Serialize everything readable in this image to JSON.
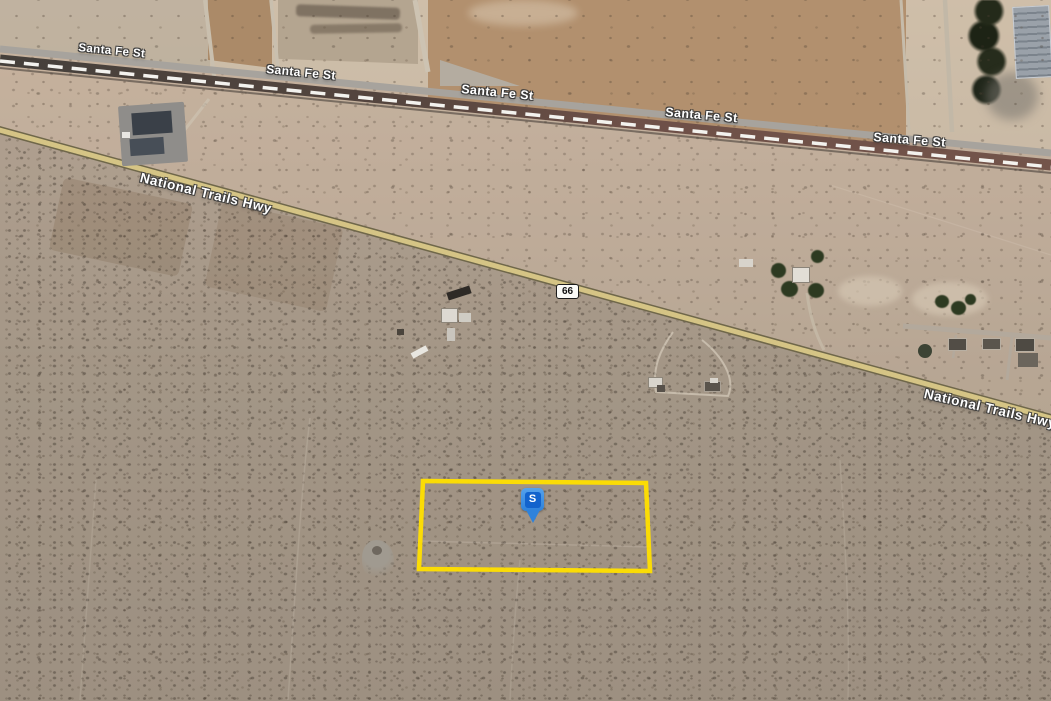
{
  "map": {
    "road_labels": [
      {
        "name": "santa-fe-st-1",
        "text": "Santa Fe St"
      },
      {
        "name": "santa-fe-st-2",
        "text": "Santa Fe St"
      },
      {
        "name": "santa-fe-st-3",
        "text": "Santa Fe St"
      },
      {
        "name": "santa-fe-st-4",
        "text": "Santa Fe St"
      },
      {
        "name": "santa-fe-st-5",
        "text": "Santa Fe St"
      },
      {
        "name": "national-trails-hwy-1",
        "text": "National Trails Hwy"
      },
      {
        "name": "national-trails-hwy-2",
        "text": "National Trails Hwy"
      }
    ],
    "route_shield": {
      "label": "66"
    },
    "property_pin": {
      "label": "S",
      "color": "#2e82db"
    },
    "parcel_outline": {
      "color": "#ffdf00"
    },
    "highway_color": "#d5c485",
    "icons": [
      {
        "name": "location-pin-icon",
        "glyph": "S"
      },
      {
        "name": "route-66-shield-icon",
        "glyph": "66"
      }
    ]
  }
}
